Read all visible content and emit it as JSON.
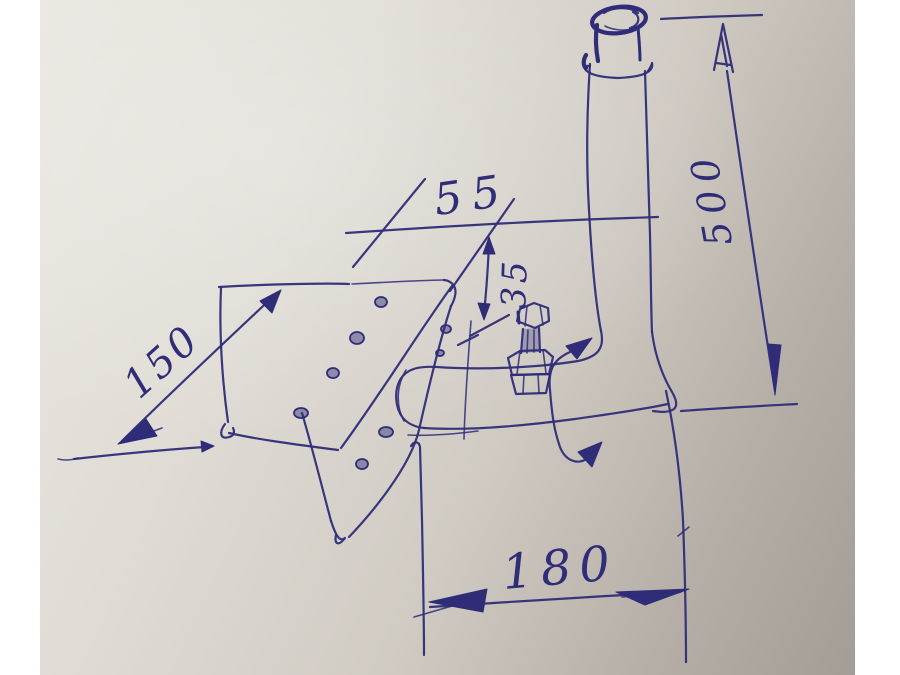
{
  "drawing": {
    "dimensions": {
      "plate_length": "150",
      "top_width": "55",
      "drop": "35",
      "pipe_height": "500",
      "bottom_run": "180"
    },
    "colors": {
      "ink": "#2f2c78",
      "paper_light": "#eae7e0",
      "paper_dark": "#a49d95",
      "margin": "#ffffff"
    }
  }
}
